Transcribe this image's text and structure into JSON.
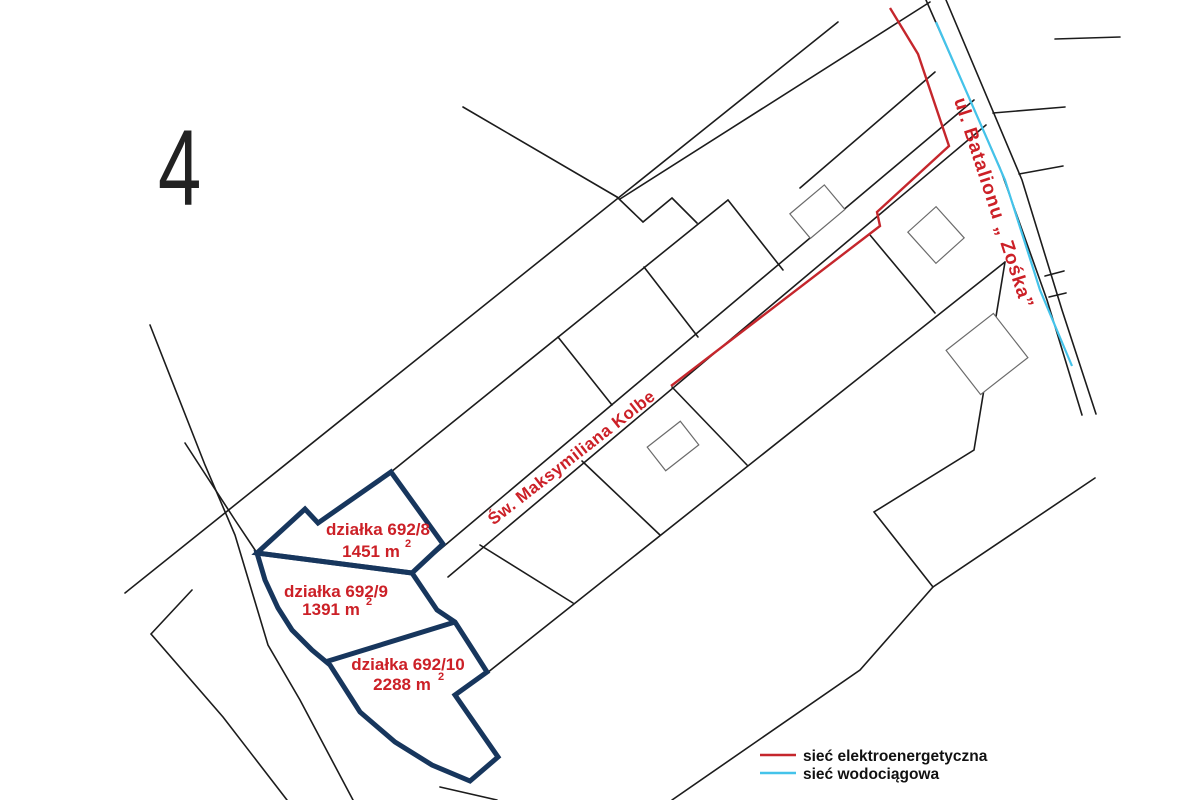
{
  "map_sheet": {
    "number": "4"
  },
  "parcels": [
    {
      "label": "działka 692/8",
      "area": "1451 m",
      "area_exponent": "2"
    },
    {
      "label": "działka 692/9",
      "area": "1391 m",
      "area_exponent": "2"
    },
    {
      "label": "działka 692/10",
      "area": "2288 m",
      "area_exponent": "2"
    }
  ],
  "streets": [
    {
      "name": "Św. Maksymiliana Kolbe"
    },
    {
      "name": "ul. Batalionu „ Zośka”"
    }
  ],
  "legend": {
    "items": [
      {
        "label": "sieć elektroenergetyczna",
        "color": "#c5262c"
      },
      {
        "label": "sieć wodociągowa",
        "color": "#44c3ea"
      }
    ]
  },
  "colors": {
    "parcel_outline": "#17365d",
    "label_red": "#cc2027",
    "boundary": "#1c1c1c"
  }
}
